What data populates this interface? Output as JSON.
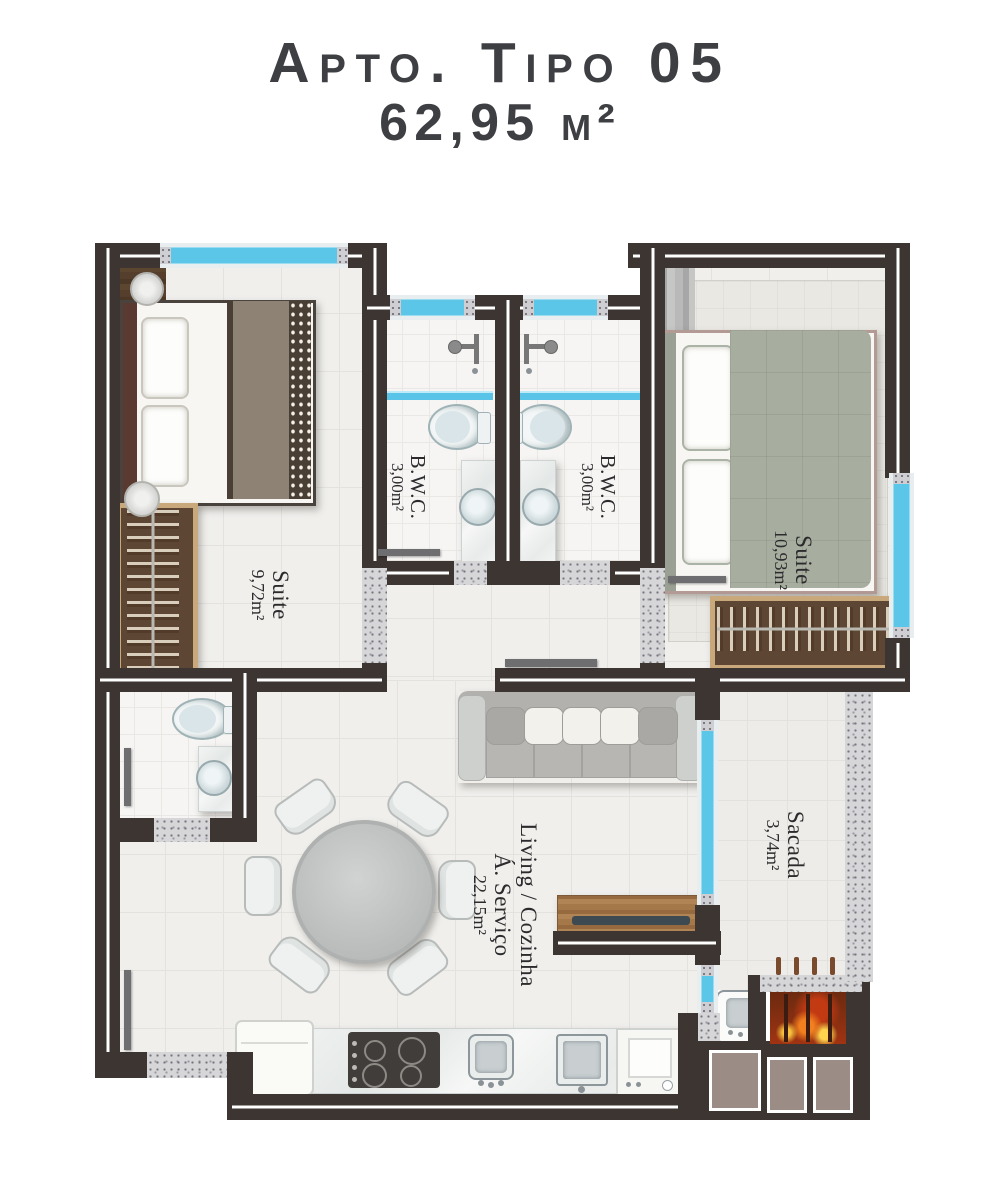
{
  "title": {
    "line1": "Apto. Tipo 05",
    "line2": "62,95 m²"
  },
  "rooms": {
    "suite1": {
      "name": "Suite",
      "area": "9,72m²"
    },
    "bwc1": {
      "name": "B.W.C.",
      "area": "3,00m²"
    },
    "bwc2": {
      "name": "B.W.C.",
      "area": "3,00m²"
    },
    "suite2": {
      "name": "Suite",
      "area": "10,93m²"
    },
    "living": {
      "name_line1": "Living / Cozinha",
      "name_line2": "Á. Serviço",
      "area": "22,15m²"
    },
    "sacada": {
      "name": "Sacada",
      "area": "3,74m²"
    }
  },
  "colors": {
    "wall": "#3c3532",
    "wall_inner_line": "#ffffff",
    "window_glass": "#5cc6e8",
    "floor_tile": "#f0efec",
    "door_threshold": "#d6d6d9",
    "wood": "#8a6547",
    "flame": "#f2801f",
    "masonry_block": "#9c8c86",
    "text": "#2b2b2d"
  },
  "furniture": {
    "suite1": [
      "double-bed",
      "wardrobe",
      "ceiling-light"
    ],
    "suite2": [
      "double-bed",
      "wardrobe",
      "rug"
    ],
    "bwc1": [
      "shower",
      "toilet",
      "sink-counter"
    ],
    "bwc2": [
      "shower",
      "toilet",
      "sink-counter"
    ],
    "wc3": [
      "toilet",
      "sink-counter"
    ],
    "living": [
      "sofa",
      "round-dining-table",
      "six-chairs",
      "tv-rack",
      "fridge",
      "cooktop",
      "kitchen-sink",
      "laundry-tank",
      "washing-machine"
    ],
    "sacada": [
      "barbecue-grill",
      "support-sink"
    ]
  }
}
